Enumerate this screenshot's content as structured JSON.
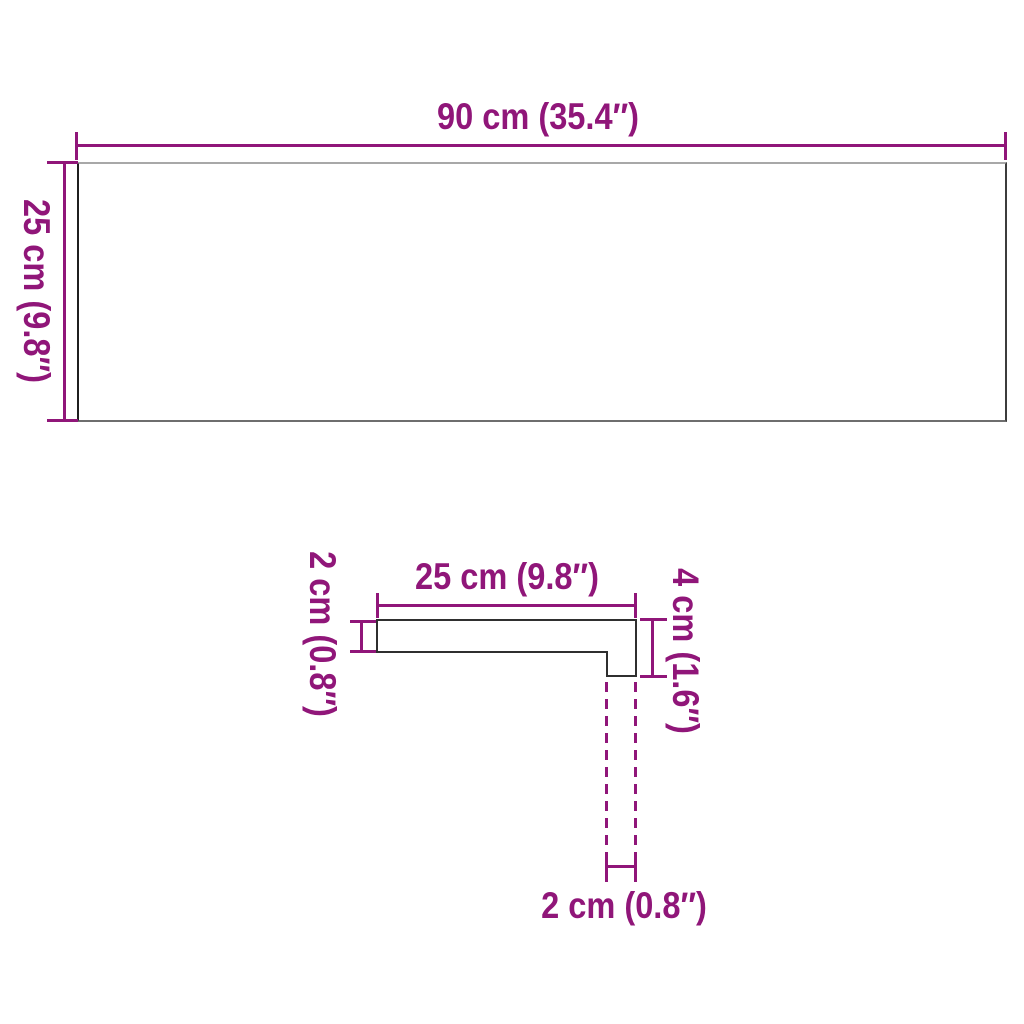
{
  "colors": {
    "accent": "#901679",
    "profile_outline": "#2f2f2f",
    "panel_border_top": "#a8a8a8",
    "panel_border_right": "#3c3c3c",
    "panel_border_bottom": "#6e6e6e",
    "panel_border_left": "#1f1f1f",
    "background": "#ffffff"
  },
  "top_view": {
    "width_label": "90 cm (35.4″)",
    "depth_label": "25 cm (9.8″)"
  },
  "profile_view": {
    "width_label": "25 cm (9.8″)",
    "thickness_label": "2 cm (0.8″)",
    "total_height_label": "4 cm (1.6″)",
    "nose_width_label": "2 cm (0.8″)"
  }
}
